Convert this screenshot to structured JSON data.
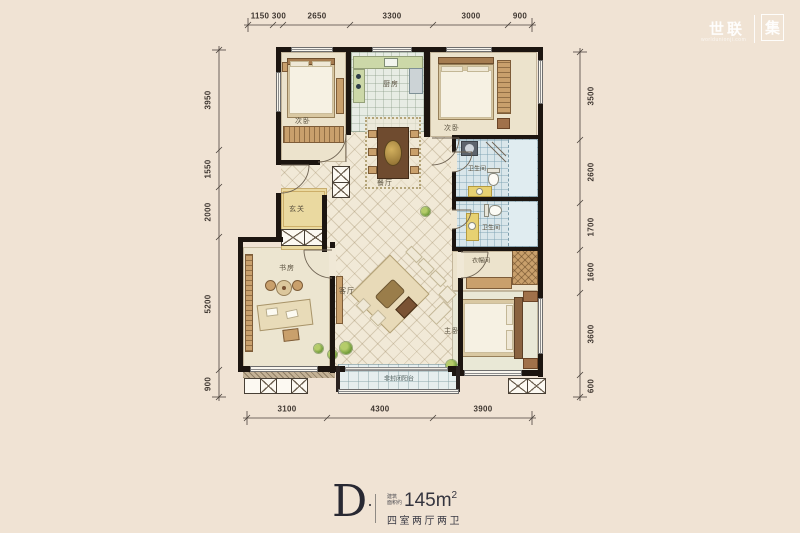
{
  "watermark": {
    "brand": "世联",
    "site": "worldunionji.com",
    "badge": "集"
  },
  "dimensions": {
    "top": [
      "1150",
      "300",
      "2650",
      "3300",
      "3000",
      "900"
    ],
    "bottom": [
      "3100",
      "4300",
      "3900"
    ],
    "left": [
      "3950",
      "1550",
      "2000",
      "5200",
      "900"
    ],
    "right": [
      "3500",
      "2600",
      "1700",
      "1600",
      "3600",
      "600"
    ]
  },
  "rooms": {
    "bedroom_tl": "次卧",
    "kitchen": "厨房",
    "bedroom_tr": "次卧",
    "bath1": "卫生间",
    "bath2": "卫生间",
    "dining": "餐厅",
    "entry": "玄关",
    "study": "书房",
    "living": "客厅",
    "closet": "衣帽间",
    "master": "主卧",
    "balcony": "非封闭阳台"
  },
  "footer": {
    "unit": "D",
    "area_prefix_1": "建筑",
    "area_prefix_2": "面积约",
    "area_value": "145m",
    "area_sup": "2",
    "layout": "四室两厅两卫"
  }
}
